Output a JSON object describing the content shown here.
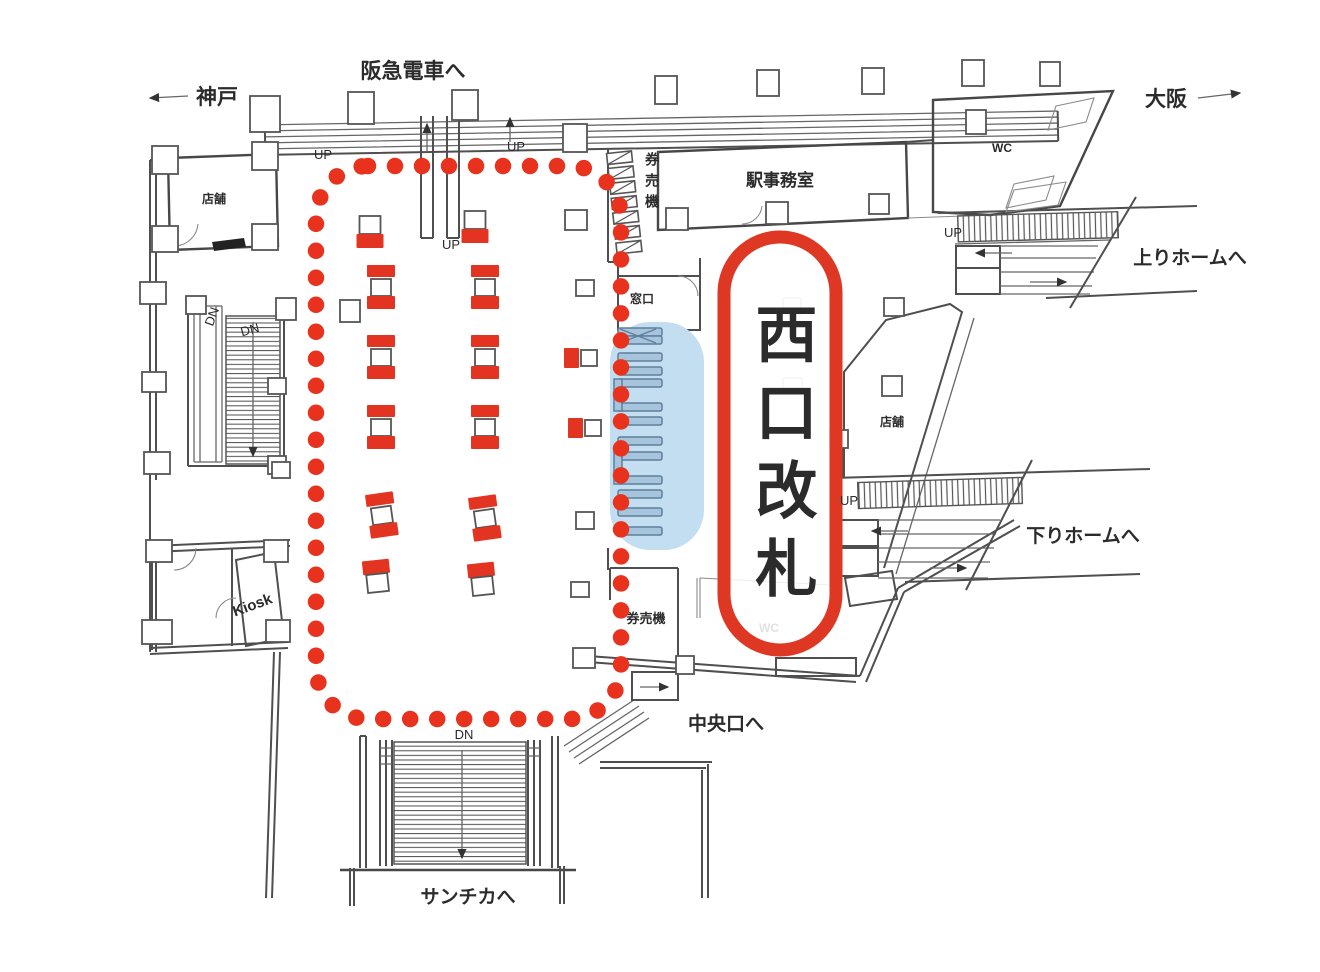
{
  "colors": {
    "highlight_red": "#e23420",
    "dotted_red": "#e8321d",
    "zone_blue": "#c3def0",
    "gate_fill": "#a6c4db",
    "gate_stroke": "#5e7f9b",
    "wall_gray": "#4f4f4f"
  },
  "labels": {
    "to_hankyu": "阪急電車へ",
    "kobe": "神戸",
    "osaka": "大阪",
    "station_office": "駅事務室",
    "ticket_machines_top": "券売機",
    "ticket_window": "窓口",
    "wc_upper": "WC",
    "wc_lower": "WC",
    "to_up_platform": "上りホームへ",
    "to_down_platform": "下りホームへ",
    "shop_upper_left": "店舗",
    "shop_right": "店舗",
    "kiosk": "Kiosk",
    "ticket_machines_lower": "券売機",
    "to_central_exit": "中央口へ",
    "to_santica": "サンチカへ",
    "west_gate": "西口改札"
  },
  "direction_labels": [
    {
      "text": "UP",
      "x": 323,
      "y": 159
    },
    {
      "text": "UP",
      "x": 516,
      "y": 151
    },
    {
      "text": "UP",
      "x": 451,
      "y": 249
    },
    {
      "text": "UP",
      "x": 953,
      "y": 237
    },
    {
      "text": "UP",
      "x": 849,
      "y": 505
    },
    {
      "text": "DN",
      "x": 216,
      "y": 318,
      "rotate": -70
    },
    {
      "text": "DN",
      "x": 251,
      "y": 334,
      "rotate": -15
    },
    {
      "text": "DN",
      "x": 464,
      "y": 739
    }
  ],
  "pillar_markers": [
    {
      "type": "square-top",
      "x": 370,
      "y": 236
    },
    {
      "type": "square-top",
      "x": 475,
      "y": 231
    },
    {
      "type": "ibeam",
      "x": 381,
      "y": 288
    },
    {
      "type": "ibeam",
      "x": 485,
      "y": 288
    },
    {
      "type": "ibeam",
      "x": 381,
      "y": 358
    },
    {
      "type": "ibeam",
      "x": 485,
      "y": 358
    },
    {
      "type": "side",
      "x": 580,
      "y": 358
    },
    {
      "type": "ibeam",
      "x": 381,
      "y": 428
    },
    {
      "type": "ibeam",
      "x": 485,
      "y": 428
    },
    {
      "type": "side",
      "x": 584,
      "y": 428
    },
    {
      "type": "ibeam",
      "x": 382,
      "y": 516,
      "rot": -8
    },
    {
      "type": "ibeam",
      "x": 485,
      "y": 519,
      "rot": -8
    },
    {
      "type": "square-bottom",
      "x": 377,
      "y": 577,
      "rot": -6
    },
    {
      "type": "square-bottom",
      "x": 482,
      "y": 580,
      "rot": -6
    }
  ],
  "ticket_gates": {
    "zone": {
      "x": 610,
      "y": 322,
      "w": 94,
      "h": 228,
      "r": 40
    },
    "bar_x": 618,
    "bar_w": 44,
    "rows": [
      {
        "y": 336,
        "type": "crossed"
      },
      {
        "y": 357,
        "type": "bar"
      },
      {
        "y": 371,
        "type": "bar"
      },
      {
        "y": 383,
        "type": "housing",
        "h": 28
      },
      {
        "y": 421,
        "type": "bar"
      },
      {
        "y": 441,
        "type": "bar"
      },
      {
        "y": 456,
        "type": "housing",
        "h": 28
      },
      {
        "y": 494,
        "type": "bar"
      },
      {
        "y": 512,
        "type": "bar"
      },
      {
        "y": 531,
        "type": "bar"
      }
    ]
  },
  "dotted_region": {
    "x": 316,
    "y": 166,
    "w": 305,
    "h": 553,
    "r": 52
  },
  "west_gate_capsule": {
    "x": 724,
    "y": 237,
    "w": 112,
    "h": 413,
    "r": 56
  }
}
